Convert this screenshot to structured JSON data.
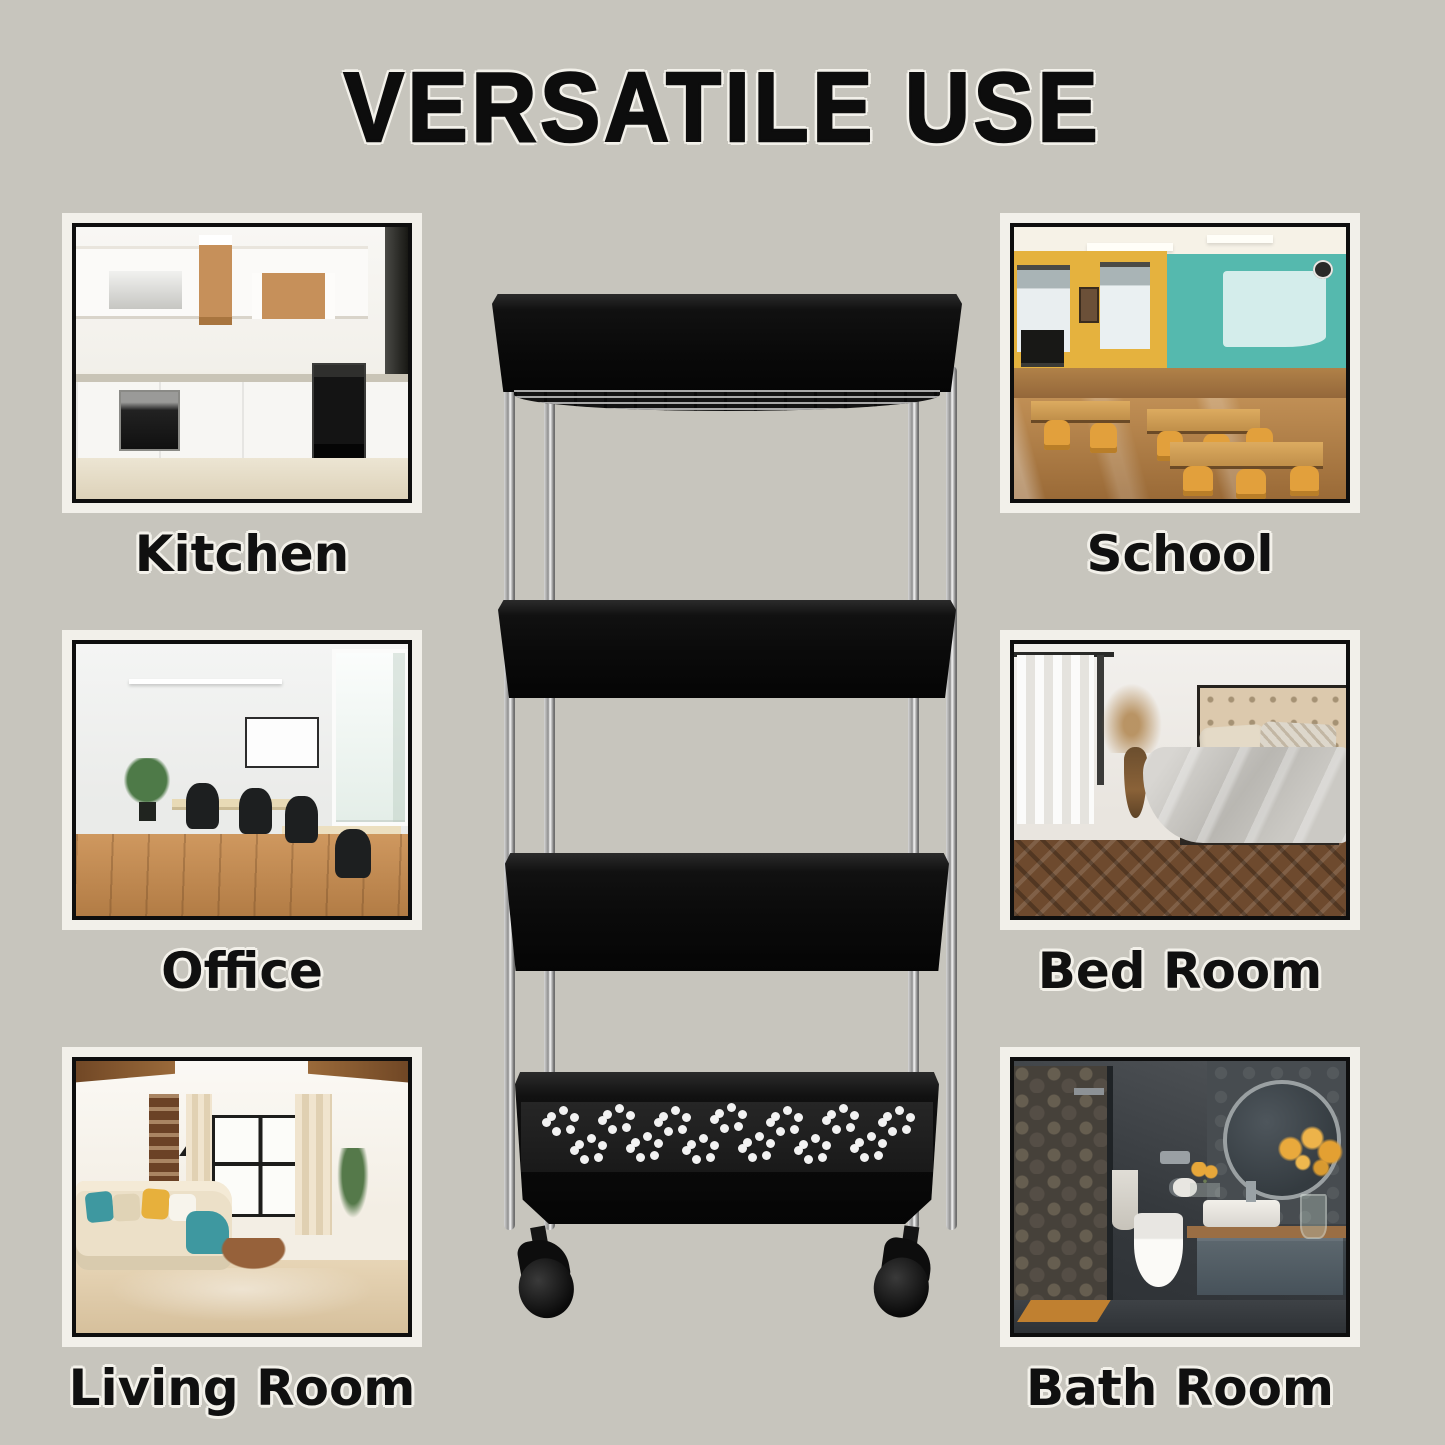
{
  "title": "VERSATILE USE",
  "cards": [
    {
      "id": "kitchen",
      "label": "Kitchen",
      "photo": "modern white kitchen with built-in black ovens, range hood and wood open shelves"
    },
    {
      "id": "school",
      "label": "School",
      "photo": "classroom with wooden tables, orange chairs, yellow window wall and teal back wall"
    },
    {
      "id": "office",
      "label": "Office",
      "photo": "bright office with wooden floor, white desks, black swivel chairs, plant and tall window"
    },
    {
      "id": "bedroom",
      "label": "Bed Room",
      "photo": "bedroom with beige tufted headboard, grey bedding, dried-flower vase, white curtains and herringbone floor"
    },
    {
      "id": "livingroom",
      "label": "Living Room",
      "photo": "living room with cream corner sofa, teal and yellow cushions, round wood coffee table and large window"
    },
    {
      "id": "bathroom",
      "label": "Bath Room",
      "photo": "dark grey bathroom with pebble-tile shower, round mirror, white basin, toilet, yellow flowers and orange mat"
    }
  ],
  "product": {
    "name": "4-tier slim rolling storage cart",
    "tier_count": 4,
    "body_color": "#0d0d0d",
    "pole_finish": "chrome",
    "visible_wheel_count": 2
  },
  "colors": {
    "background": "#c7c5bd",
    "text": "#101010",
    "text_halo": "#f3f1ea",
    "frame_white": "#f2f0ea",
    "frame_black": "#0e0e0e"
  }
}
